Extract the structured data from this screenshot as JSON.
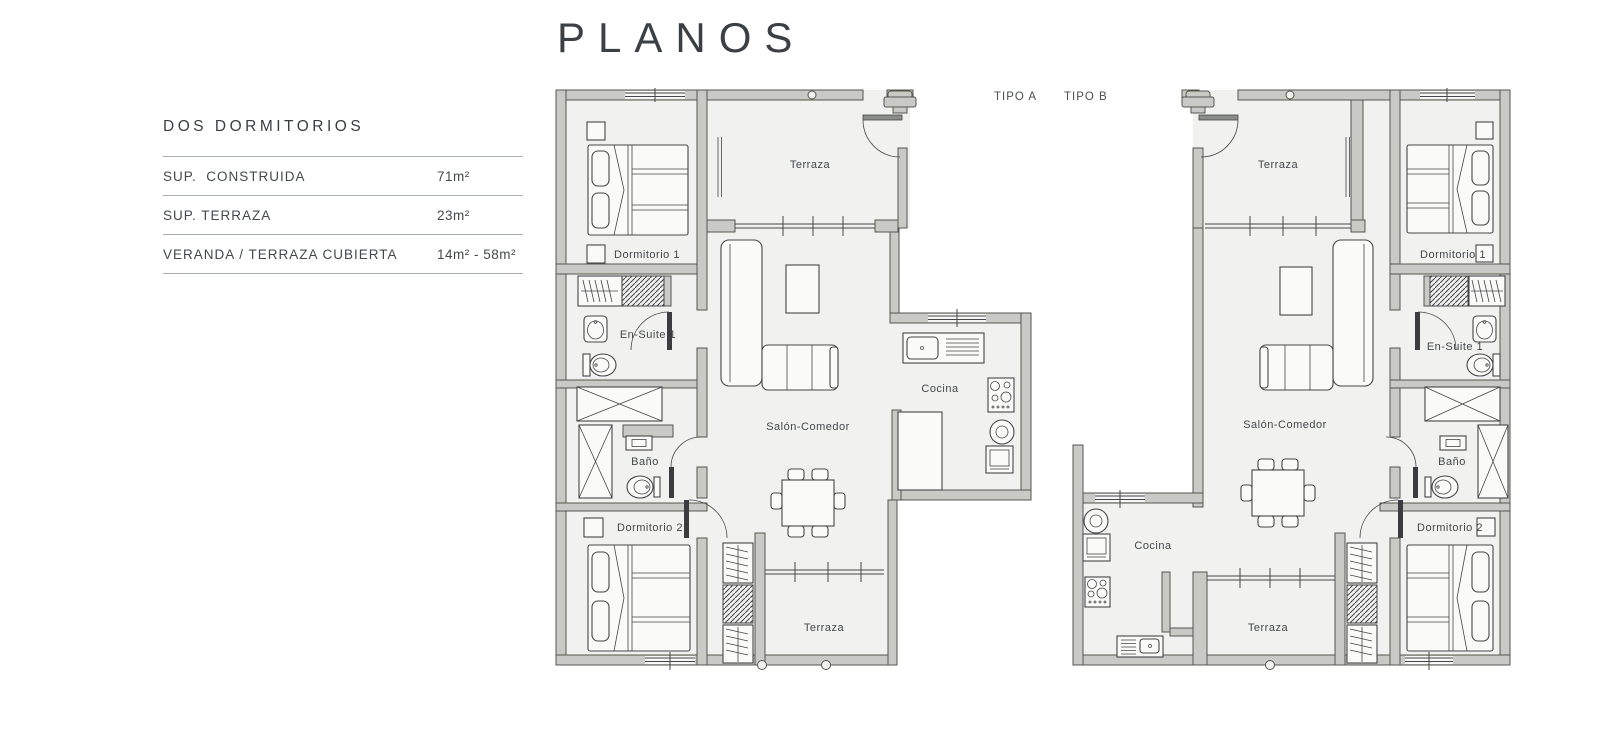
{
  "page": {
    "title": "PLANOS"
  },
  "sidebar": {
    "heading": "DOS DORMITORIOS",
    "specs": [
      {
        "label": "SUP.  CONSTRUIDA",
        "value": "71m²"
      },
      {
        "label": "SUP. TERRAZA",
        "value": "23m²"
      },
      {
        "label": "VERANDA / TERRAZA CUBIERTA",
        "value": "14m² - 58m²"
      }
    ]
  },
  "plans": [
    {
      "id": "tipo-a",
      "type_label": "TIPO A",
      "rooms": {
        "terraza_top": "Terraza",
        "dormitorio_1": "Dormitorio 1",
        "en_suite_1": "En-Suite 1",
        "bano": "Baño",
        "dormitorio_2": "Dormitorio 2",
        "salon_comedor": "Salón-Comedor",
        "cocina": "Cocina",
        "terraza_bottom": "Terraza"
      }
    },
    {
      "id": "tipo-b",
      "type_label": "TIPO B",
      "rooms": {
        "terraza_top": "Terraza",
        "dormitorio_1": "Dormitorio 1",
        "en_suite_1": "En-Suite 1",
        "bano": "Baño",
        "dormitorio_2": "Dormitorio 2",
        "salon_comedor": "Salón-Comedor",
        "cocina": "Cocina",
        "terraza_bottom": "Terraza"
      }
    }
  ],
  "colors": {
    "wall": "#c9cac5",
    "wall_outline": "#56564f",
    "floor": "#f1f1ef",
    "furniture_line": "#46464a",
    "label_text": "#43474b",
    "heading_text": "#393e42"
  }
}
